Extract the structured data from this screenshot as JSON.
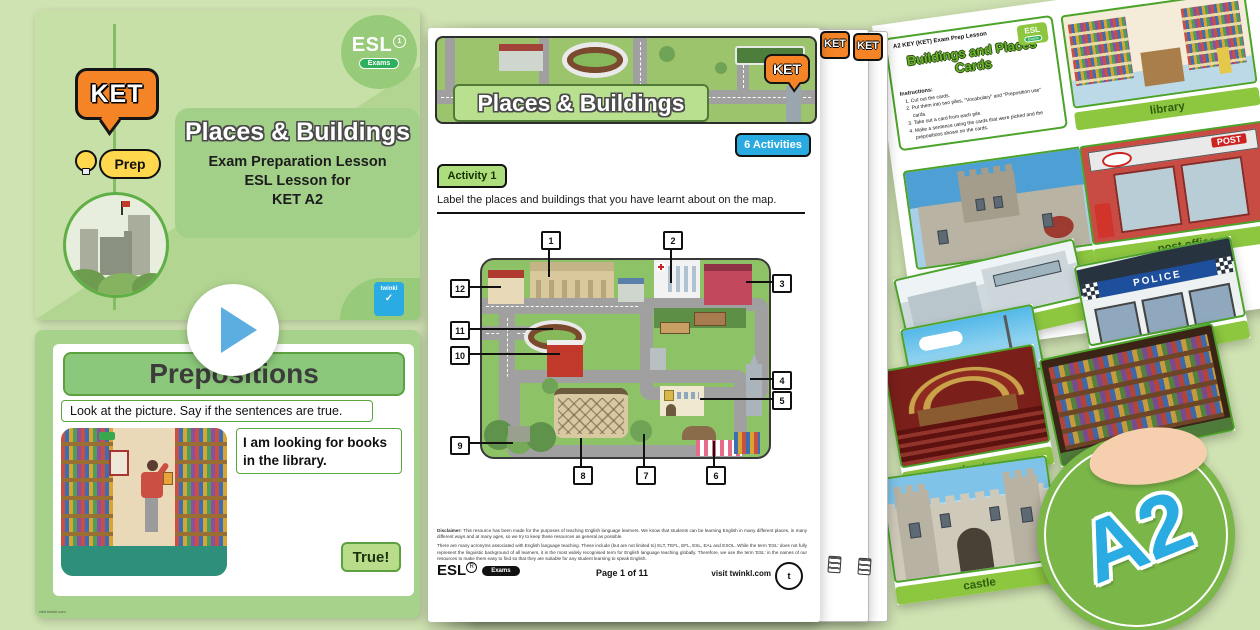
{
  "slide1": {
    "ket_badge": "KET",
    "prep_badge": "Prep",
    "esl_logo": "ESL",
    "esl_sub": "Exams",
    "title": "Places & Buildings",
    "subtitle_line1": "Exam Preparation Lesson",
    "subtitle_line2": "ESL Lesson for",
    "subtitle_line3": "KET A2",
    "brand": "twinkl"
  },
  "slide2": {
    "title": "Prepositions",
    "instruction": "Look at the picture. Say if the sentences are true.",
    "sentence": "I am looking for books in the library.",
    "answer_button": "True!",
    "footer": "visit twinkl.com"
  },
  "worksheet": {
    "header_title": "Places & Buildings",
    "ket_badge": "KET",
    "activities_badge": "6 Activities",
    "activity_badge": "Activity 1",
    "instruction": "Label the places and buildings that you have learnt about on the map.",
    "map_numbers": [
      "1",
      "2",
      "3",
      "4",
      "5",
      "6",
      "7",
      "8",
      "9",
      "10",
      "11",
      "12"
    ],
    "disclaimer_label": "Disclaimer:",
    "disclaimer_1": "This resource has been made for the purposes of teaching English language learners. We know that students can be learning English in many different places, in many different ways and at many ages, so we try to keep these resources as general as possible.",
    "disclaimer_2": "There are many acronyms associated with English language teaching. These include (but are not limited to) ELT, TEFL, EFL, ESL, EAL and ESOL. While the term 'ESL' does not fully represent the linguistic background of all learners, it is the most widely recognised term for English language teaching globally. Therefore, we use the term 'ESL' in the names of our resources to make them easy to find so that they are suitable for any student learning to speak English.",
    "footer_logo": "ESL",
    "footer_logo_sub": "Exams",
    "page_label": "Page 1 of 11",
    "site": "visit twinkl.com"
  },
  "cards": {
    "header": "A2 KEY (KET) Exam Prep Lesson",
    "esl_logo": "ESL",
    "esl_sub": "Exams",
    "title_line1": "Buildings and Places",
    "title_line2": "Cards",
    "instructions_label": "Instructions:",
    "instructions": [
      "Cut out the cards.",
      "Put them into two piles, \"Vocabulary\" and \"Preposition use\" cards.",
      "Take out a card from each pile.",
      "Make a sentence using the cards that were picked and the prepositions shown on the cards."
    ],
    "labels": {
      "library": "library",
      "castle": "castle",
      "post_office": "post office",
      "museum": "museum",
      "police": "police",
      "theatre": "theatre",
      "castle2": "castle"
    },
    "post_sign": "POST",
    "police_sign": "POLICE"
  },
  "badge": {
    "level": "A2"
  }
}
